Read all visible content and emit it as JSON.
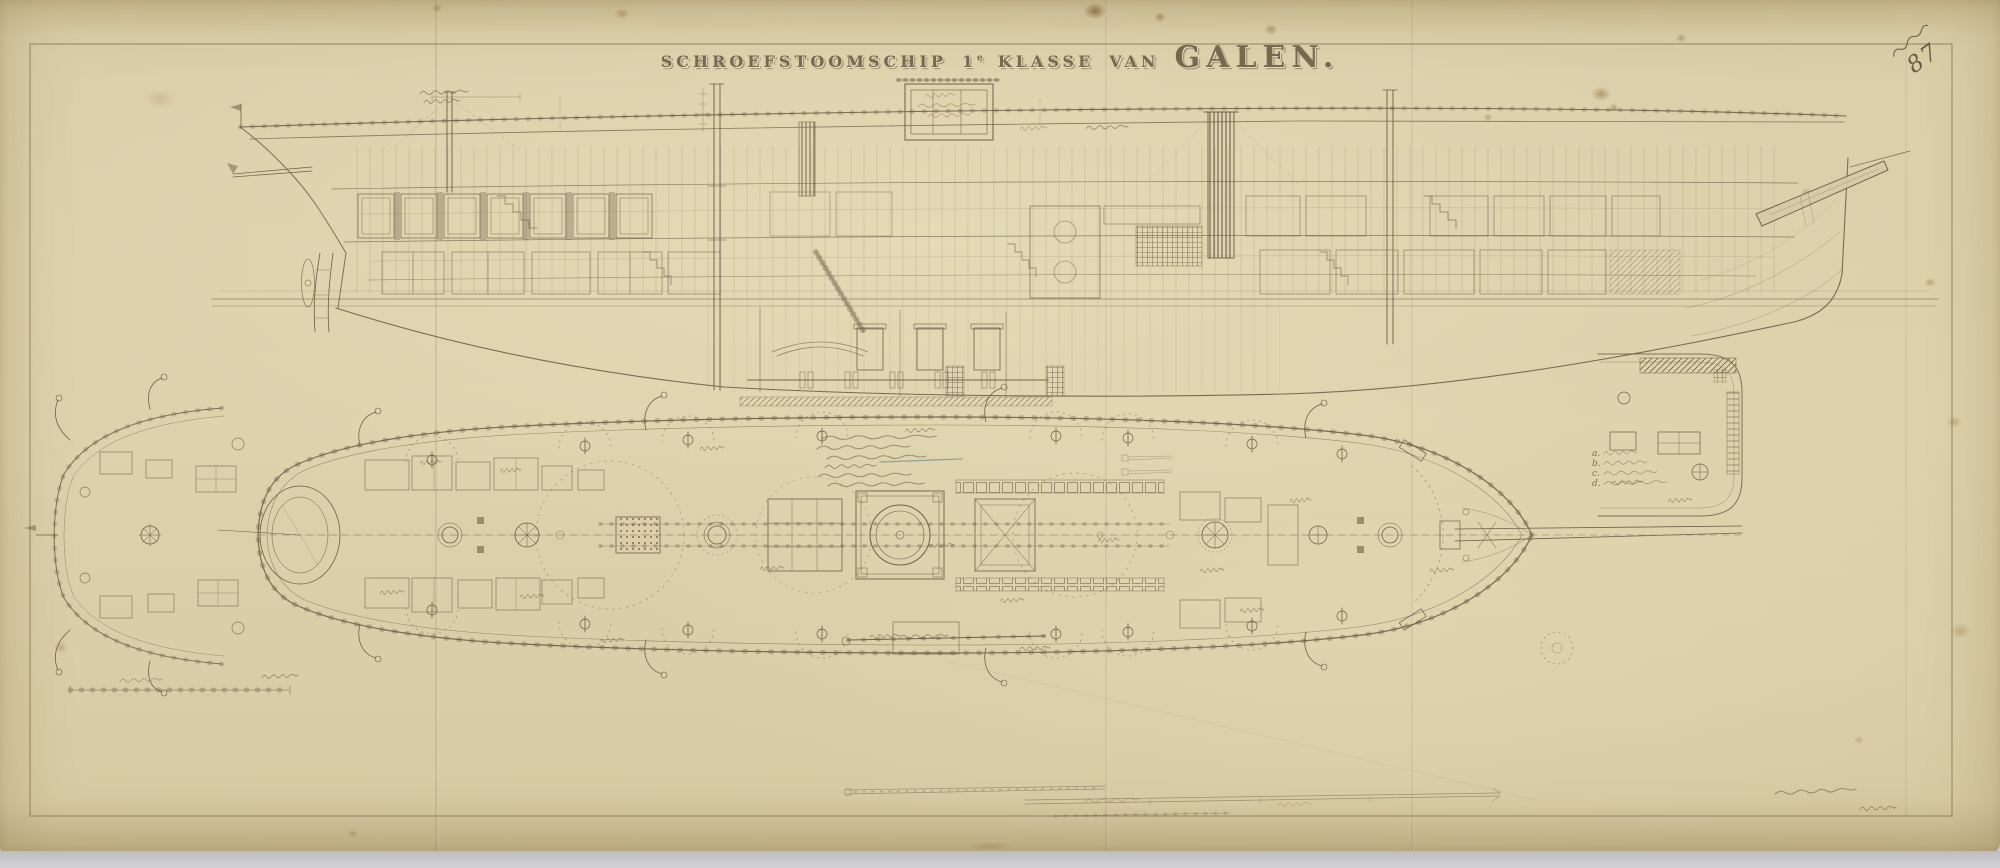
{
  "sheet": {
    "title": {
      "ship_type": "SCHROEFSTOOMSCHIP",
      "class_number": "1",
      "class_suffix": "e",
      "class_word": "KLASSE",
      "connector": "VAN",
      "ship_name": "GALEN."
    },
    "corner_number": "87",
    "legend_items": [
      {
        "key": "a."
      },
      {
        "key": "b."
      },
      {
        "key": "c."
      },
      {
        "key": "d."
      }
    ],
    "colors": {
      "paper": "#d9cfa9",
      "ink": "#6e5f49",
      "dark_ink": "#4a4030",
      "red_ink": "#96604b",
      "blue_pencil": "#4e7d7d"
    }
  }
}
